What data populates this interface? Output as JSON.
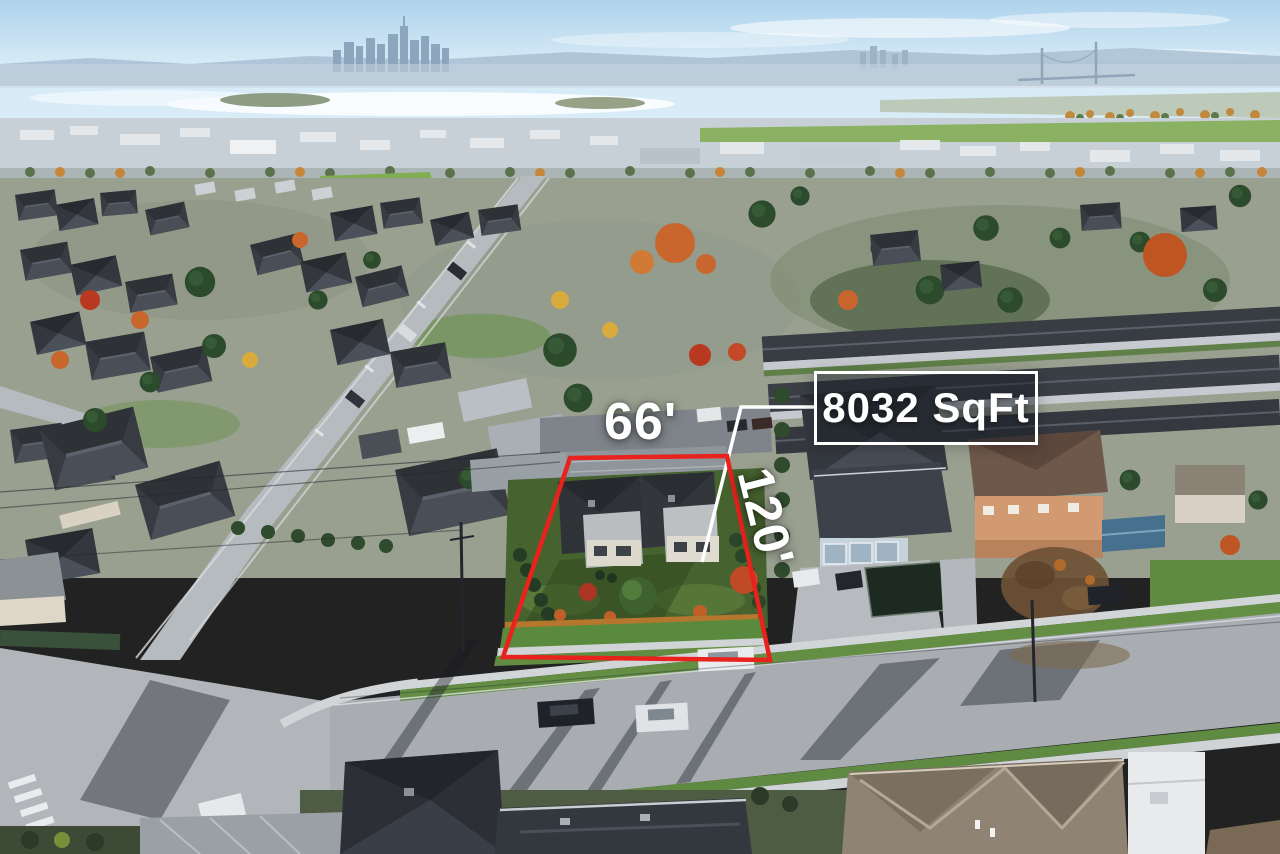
{
  "annotations": {
    "lot_width_label": "66'",
    "lot_depth_label": "120'",
    "lot_area_label": "8032 SqFt"
  },
  "colors": {
    "outline_red": "#e8221c",
    "annotation_white": "#ffffff",
    "callout_bg": "rgba(24,30,38,0.48)"
  }
}
